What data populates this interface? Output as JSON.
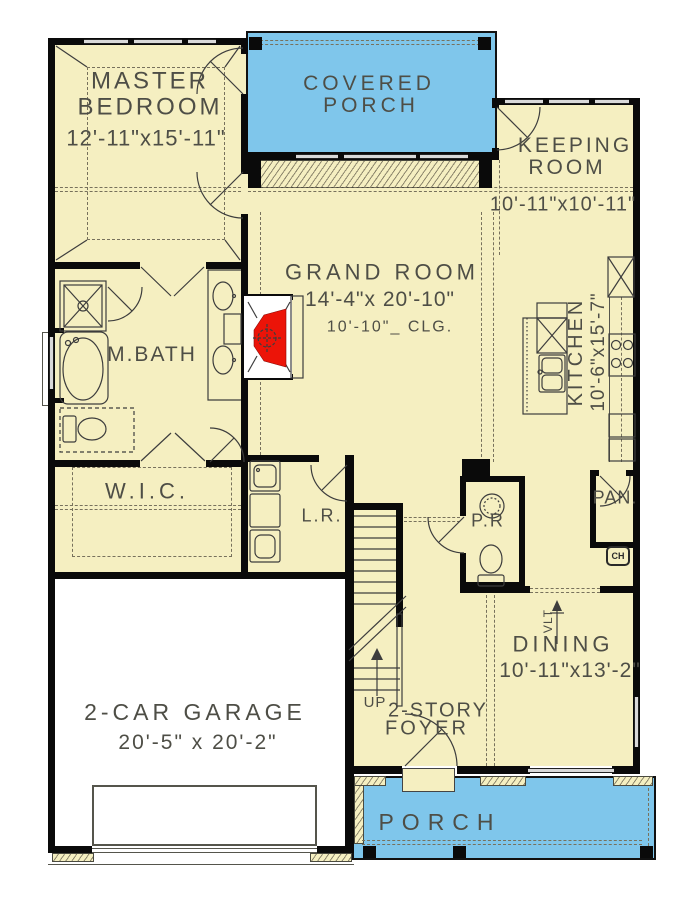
{
  "colors": {
    "floor": "#f5efc1",
    "porch_blue": "#7fc6eb",
    "garage_floor": "#ffffff",
    "wall": "#000000",
    "fireplace_red": "#ec1408",
    "line": "#3d3d3d",
    "text": "#4e4e46"
  },
  "rooms": {
    "master_bedroom": {
      "name_line1": "MASTER",
      "name_line2": "BEDROOM",
      "dims": "12'-11\"x15'-11\""
    },
    "covered_porch": {
      "name_line1": "COVERED",
      "name_line2": "PORCH"
    },
    "keeping_room": {
      "name_line1": "KEEPING",
      "name_line2": "ROOM",
      "dims": "10'-11\"x10'-11\""
    },
    "grand_room": {
      "name": "GRAND ROOM",
      "dims": "14'-4\"x 20'-10\"",
      "ceiling": "10'-10\"_ CLG."
    },
    "master_bath": {
      "name": "M.BATH"
    },
    "walk_in_closet": {
      "name": "W.I.C."
    },
    "laundry_room": {
      "name": "L.R."
    },
    "kitchen": {
      "name": "KITCHEN",
      "dims": "10'-6\"x15'-7\""
    },
    "pantry": {
      "name": "PAN."
    },
    "powder_room": {
      "name": "P.R"
    },
    "dining": {
      "name": "DINING",
      "dims": "10'-11\"x13'-2\"",
      "vault_marker": "VLT"
    },
    "foyer": {
      "name_line1": "2-STORY",
      "name_line2": "FOYER",
      "stair_label": "UP"
    },
    "garage": {
      "name": "2-CAR GARAGE",
      "dims": "20'-5\" x 20'-2\""
    },
    "porch": {
      "name": "PORCH"
    },
    "misc": {
      "chase_marker": "CH"
    }
  }
}
